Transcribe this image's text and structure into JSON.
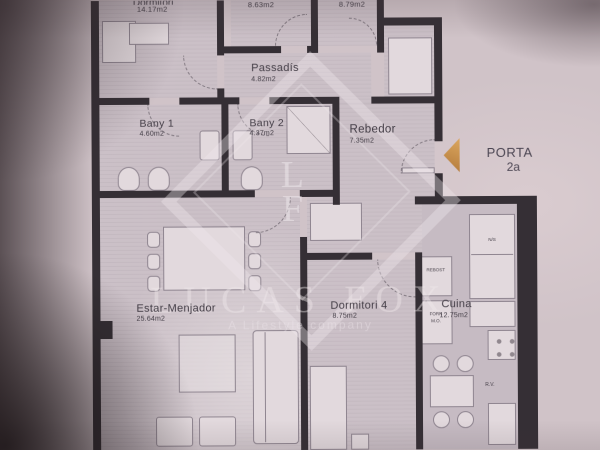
{
  "plan": {
    "rooms": [
      {
        "id": "dormitori-top",
        "name": "Dormitori",
        "area": "14.17m2"
      },
      {
        "id": "room-second",
        "name": "",
        "area": "8.63m2"
      },
      {
        "id": "room-third",
        "name": "",
        "area": "8.79m2"
      },
      {
        "id": "passadis",
        "name": "Passadís",
        "area": "4.82m2"
      },
      {
        "id": "bany1",
        "name": "Bany 1",
        "area": "4.60m2"
      },
      {
        "id": "bany2",
        "name": "Bany 2",
        "area": "4.37m2"
      },
      {
        "id": "rebedor",
        "name": "Rebedor",
        "area": "7.35m2"
      },
      {
        "id": "estar-menjador",
        "name": "Estar-Menjador",
        "area": "25.64m2"
      },
      {
        "id": "dormitori4",
        "name": "Dormitori 4",
        "area": "8.75m2"
      },
      {
        "id": "cuina",
        "name": "Cuina",
        "area": "12.75m2"
      }
    ],
    "kitchen_labels": {
      "pantry": "REBOST",
      "oven_line1": "FORN",
      "oven_line2": "M.O.",
      "fridge": "N/S",
      "dishwasher": "R.V."
    },
    "entrance": {
      "line1": "PORTA",
      "line2": "2a"
    }
  },
  "watermark": {
    "monogram_top": "L",
    "monogram_bottom": "F",
    "brand": "LUCAS FOX",
    "tagline": "A Lifestyle company"
  },
  "colors": {
    "paper": "#d0c3c8",
    "room": "#cbc0c7",
    "wall": "#352f35",
    "fur": "#e2d9dd",
    "furline": "#8f8590",
    "label": "#433d46",
    "arc": "rgba(70,62,72,0.55)",
    "wm": "rgba(240,233,237,0.45)",
    "arrow1": "#dca75f",
    "arrow2": "#b17839"
  }
}
